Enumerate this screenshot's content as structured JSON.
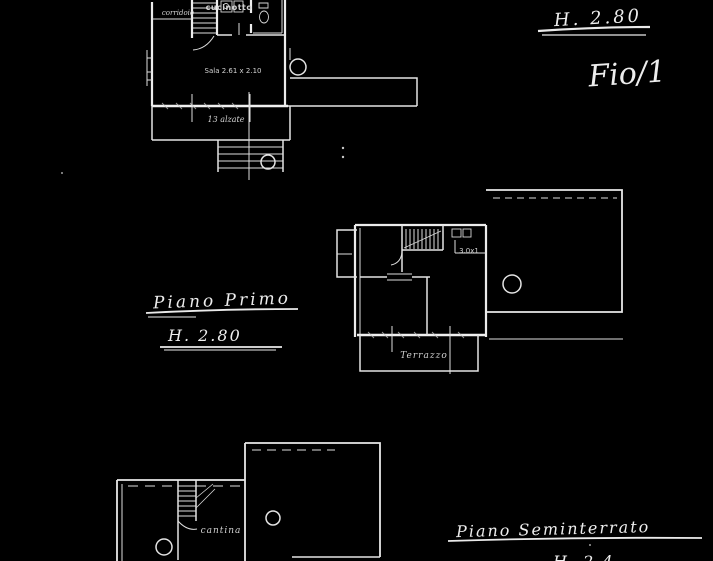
{
  "sheet": {
    "background": "#000000",
    "line_color": "#e4e4e4"
  },
  "handwritten": {
    "top_right_height": "H. 2.80",
    "sheet_number": "Fio/1",
    "first_floor_title": "Piano Primo",
    "first_floor_height": "H. 2.80",
    "basement_title": "Piano Seminterrato",
    "basement_height": "H. 2.4"
  },
  "plans": {
    "ground_floor": {
      "labels": {
        "corridor": "corridoio",
        "kitchen": "cucinotto",
        "living_room": "Sala 2.61 x 2.10",
        "stair_note": "13 alzate"
      }
    },
    "first_floor": {
      "labels": {
        "small_room": "3.0x1",
        "terrace": "Terrazzo"
      }
    },
    "basement": {
      "labels": {
        "cellar": "cantina"
      }
    }
  }
}
